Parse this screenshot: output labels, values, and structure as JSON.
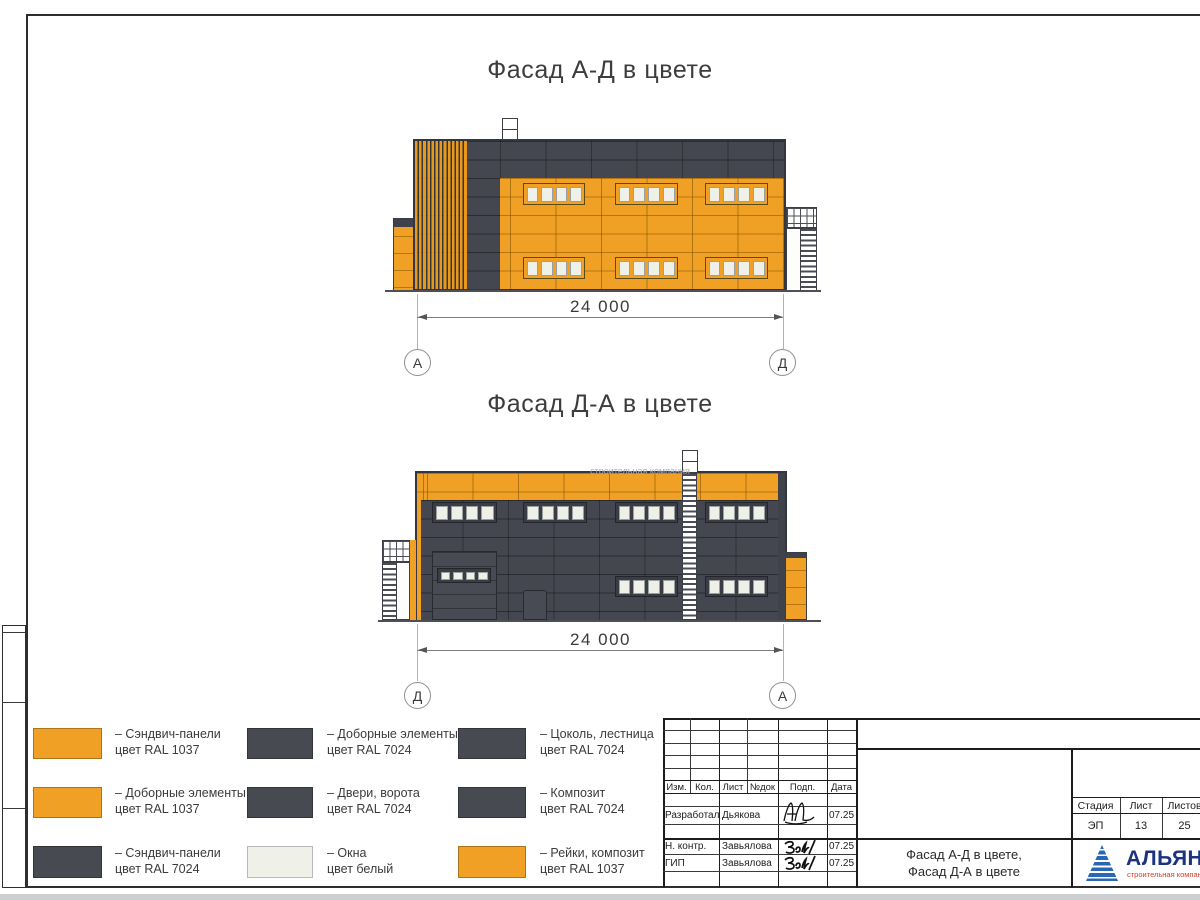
{
  "colors": {
    "facade_orange_ral1037": "#F0A125",
    "facade_dark_ral7024": "#474A51",
    "window_white": "#EFF1E8",
    "logo_blue": "#1B3380",
    "logo_red": "#D23F2C"
  },
  "facades": [
    {
      "title": "Фасад А-Д в цвете",
      "dimension": "24 000",
      "axis_left": "А",
      "axis_right": "Д"
    },
    {
      "title": "Фасад Д-А в цвете",
      "dimension": "24 000",
      "axis_left": "Д",
      "axis_right": "А"
    }
  ],
  "watermark": "строительная компания",
  "legend": {
    "items": [
      {
        "line1": "– Сэндвич-панели",
        "line2": "цвет RAL 1037",
        "color": "#F0A125"
      },
      {
        "line1": "– Доборные элементы",
        "line2": "цвет RAL 1037",
        "color": "#F0A125"
      },
      {
        "line1": "– Сэндвич-панели",
        "line2": "цвет RAL 7024",
        "color": "#474A51"
      },
      {
        "line1": "– Доборные элементы",
        "line2": "цвет RAL 7024",
        "color": "#474A51"
      },
      {
        "line1": "– Двери, ворота",
        "line2": "цвет RAL 7024",
        "color": "#474A51"
      },
      {
        "line1": "– Окна",
        "line2": "цвет белый",
        "color": "#EFF1E8"
      },
      {
        "line1": "– Цоколь, лестница",
        "line2": "цвет RAL 7024",
        "color": "#474A51"
      },
      {
        "line1": "– Композит",
        "line2": "цвет RAL 7024",
        "color": "#474A51"
      },
      {
        "line1": "– Рейки, композит",
        "line2": "цвет RAL 1037",
        "color": "#F0A125"
      }
    ]
  },
  "stamp": {
    "rev_cols": [
      "Изм.",
      "Кол.",
      "Лист",
      "№док",
      "Подп.",
      "Дата"
    ],
    "signers": [
      {
        "role": "Разработал",
        "name": "Дьякова",
        "date": "07.25"
      },
      {
        "role": "Н. контр.",
        "name": "Завьялова",
        "date": "07.25"
      },
      {
        "role": "ГИП",
        "name": "Завьялова",
        "date": "07.25"
      }
    ],
    "doc_title_line1": "Фасад А-Д в цвете,",
    "doc_title_line2": "Фасад Д-А в цвете",
    "stage": {
      "label": "Стадия",
      "value": "ЭП"
    },
    "sheet": {
      "label": "Лист",
      "value": "13"
    },
    "sheets": {
      "label": "Листов",
      "value": "25"
    },
    "logo": {
      "name": "АЛЬЯНС",
      "subtitle": "строительная компания"
    }
  }
}
